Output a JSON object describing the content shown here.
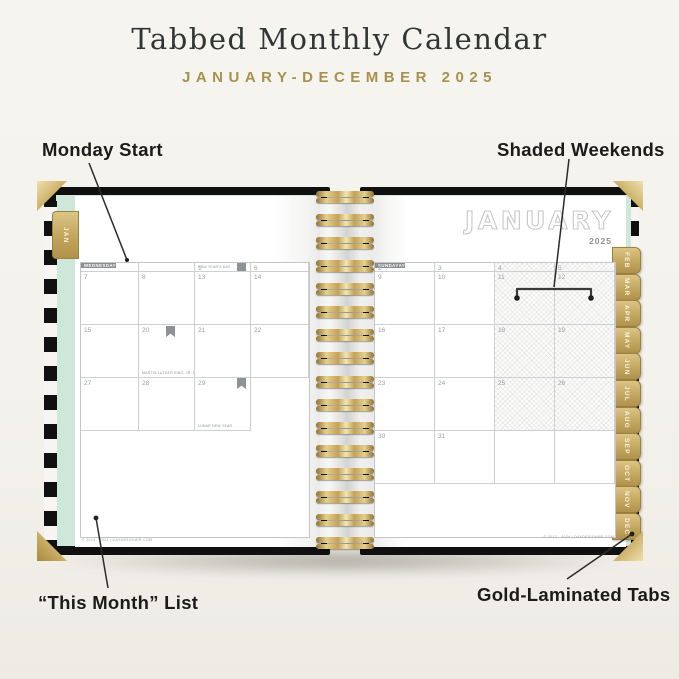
{
  "header": {
    "title": "Tabbed Monthly Calendar",
    "subtitle": "JANUARY-DECEMBER 2025"
  },
  "annotations": {
    "monday_start": "Monday Start",
    "shaded_weekends": "Shaded Weekends",
    "this_month_list": "“This Month” List",
    "gold_tabs": "Gold-Laminated Tabs"
  },
  "planner": {
    "month": "JANUARY",
    "year": "2025",
    "jan_tab": "JAN",
    "tabs": [
      "FEB",
      "MAR",
      "APR",
      "MAY",
      "JUN",
      "JUL",
      "AUG",
      "SEP",
      "OCT",
      "NOV",
      "DEC"
    ],
    "footer": "© 2013 - 2024 | DAYDESIGNER.COM",
    "left_page": {
      "headers": [
        "THIS MONTH",
        "MONDAY",
        "TUESDAY",
        "WEDNESDAY"
      ],
      "rows": [
        [
          {
            "day": ""
          },
          {
            "day": ""
          },
          {
            "day": "1",
            "flag": "right",
            "note": "NEW YEAR'S DAY"
          }
        ],
        [
          {
            "day": "6"
          },
          {
            "day": "7"
          },
          {
            "day": "8"
          }
        ],
        [
          {
            "day": "13"
          },
          {
            "day": "14"
          },
          {
            "day": "15"
          }
        ],
        [
          {
            "day": "20",
            "flag": "left",
            "note": "MARTIN LUTHER KING, JR. DAY"
          },
          {
            "day": "21"
          },
          {
            "day": "22"
          }
        ],
        [
          {
            "day": "27"
          },
          {
            "day": "28"
          },
          {
            "day": "29",
            "flag": "right",
            "note": "LUNAR NEW YEAR"
          }
        ]
      ]
    },
    "right_page": {
      "headers": [
        "THURSDAY",
        "FRIDAY",
        "SATURDAY",
        "SUNDAY"
      ],
      "rows": [
        [
          {
            "day": "2"
          },
          {
            "day": "3"
          },
          {
            "day": "4",
            "shaded": true
          },
          {
            "day": "5",
            "shaded": true
          }
        ],
        [
          {
            "day": "9"
          },
          {
            "day": "10"
          },
          {
            "day": "11",
            "shaded": true
          },
          {
            "day": "12",
            "shaded": true
          }
        ],
        [
          {
            "day": "16"
          },
          {
            "day": "17"
          },
          {
            "day": "18",
            "shaded": true
          },
          {
            "day": "19",
            "shaded": true
          }
        ],
        [
          {
            "day": "23"
          },
          {
            "day": "24"
          },
          {
            "day": "25",
            "shaded": true
          },
          {
            "day": "26",
            "shaded": true
          }
        ],
        [
          {
            "day": "30"
          },
          {
            "day": "31"
          },
          {
            "day": ""
          },
          {
            "day": ""
          }
        ]
      ]
    },
    "colors": {
      "gold": "#b3974f",
      "mint": "#cde8da",
      "header_gray": "#8b8e90",
      "cover_black": "#101010",
      "cream_bg": "#f4f2ec"
    }
  }
}
